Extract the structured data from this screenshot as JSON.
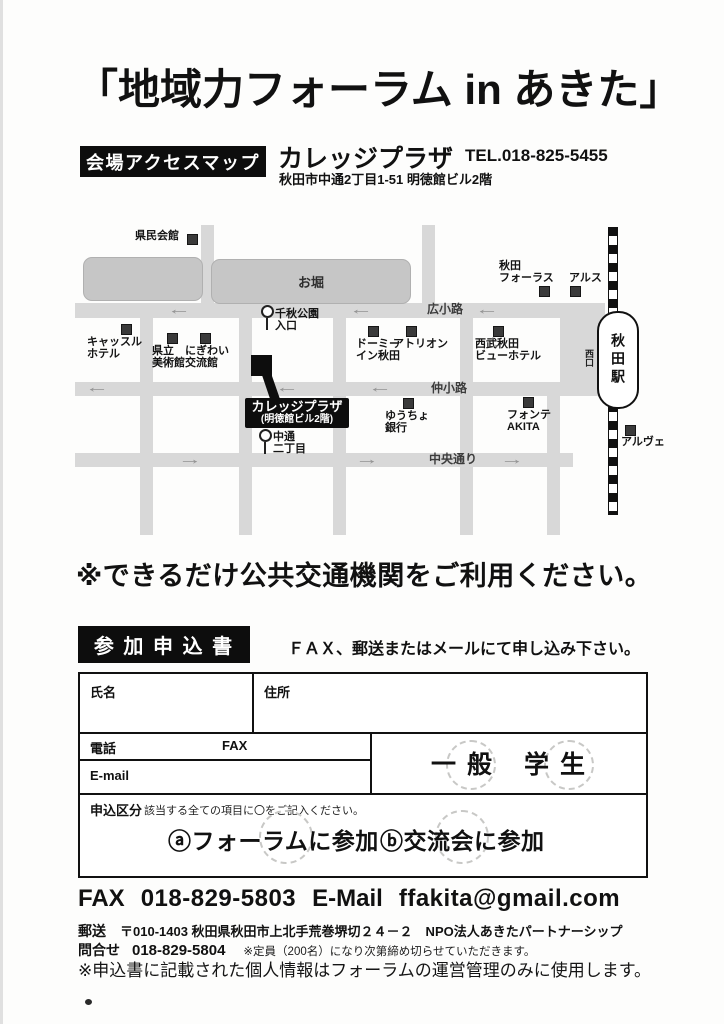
{
  "title": "「地域力フォーラム in あきた」",
  "access_map": {
    "section_label": "会場アクセスマップ",
    "venue_name": "カレッジプラザ",
    "tel": "TEL.018-825-5455",
    "address": "秋田市中通2丁目1-51 明徳館ビル2階"
  },
  "map": {
    "moat": "お堀",
    "street_hirokoji": "広小路",
    "street_nakakoji": "仲小路",
    "street_chuodori": "中央通り",
    "station_name": "秋田駅",
    "west_exit": "西口",
    "arrow_left": "←",
    "arrow_right": "→",
    "venue_box_line1": "カレッジプラザ",
    "venue_box_line2": "(明徳館ビル2階)",
    "places": [
      {
        "label": "県民会館"
      },
      {
        "label": "キャッスル\nホテル"
      },
      {
        "label": "県立\n美術館"
      },
      {
        "label": "にぎわい\n交流館"
      },
      {
        "label": "千秋公園\n入口"
      },
      {
        "label": "ドーミー\nイン秋田"
      },
      {
        "label": "アトリオン"
      },
      {
        "label": "西武秋田\nビューホテル"
      },
      {
        "label": "秋田\nフォーラス"
      },
      {
        "label": "アルス"
      },
      {
        "label": "ゆうちょ\n銀行"
      },
      {
        "label": "フォンテ\nAKITA"
      },
      {
        "label": "中通\n二丁目"
      },
      {
        "label": "アルヴェ"
      }
    ]
  },
  "transport_notice": "※できるだけ公共交通機関をご利用ください。",
  "form": {
    "section_label": "参 加 申 込 書",
    "instruction": "ＦＡＸ、郵送またはメールにて申し込み下さい。",
    "name_label": "氏名",
    "address_label": "住所",
    "phone_label": "電話",
    "fax_label": "FAX",
    "email_label": "E-mail",
    "category_general": "一 般",
    "category_student": "学 生",
    "entry_label": "申込区分",
    "entry_note": "該当する全ての項目に〇をご記入ください。",
    "option_a": "ⓐフォーラムに参加",
    "option_b": "ⓑ交流会に参加"
  },
  "contact": {
    "fax_label": "FAX",
    "fax_number": "018-829-5803",
    "email_label": "E-Mail",
    "email": "ffakita@gmail.com",
    "post_label": "郵送",
    "post_address": "〒010-1403 秋田県秋田市上北手荒巻堺切２４－２　NPO法人あきたパートナーシップ",
    "inquiry_label": "問合せ",
    "inquiry_number": "018-829-5804",
    "capacity_note": "※定員（200名）になり次第締め切らせていただきます。",
    "privacy_note": "※申込書に記載された個人情報はフォーラムの運営管理のみに使用します。"
  }
}
